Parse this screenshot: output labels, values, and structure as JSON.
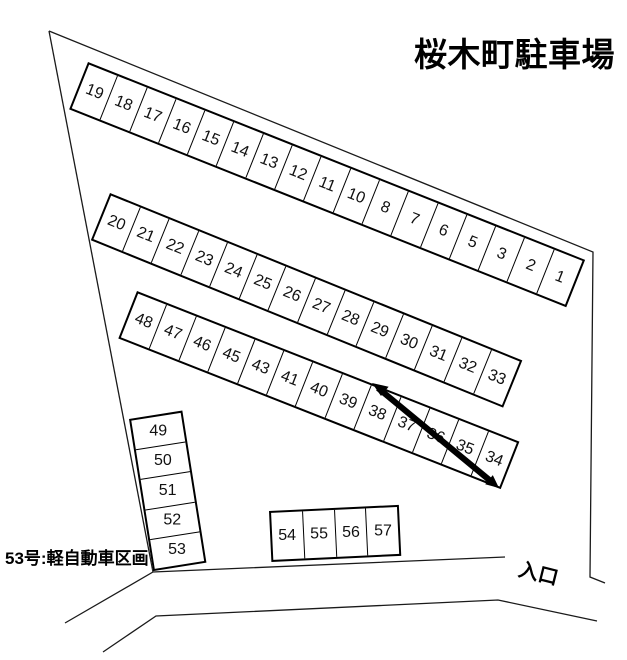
{
  "title": "桜木町駐車場",
  "notes": {
    "kei_section": "53号:軽自動車区画",
    "entrance": "入口"
  },
  "rows": [
    {
      "id": "row-upper",
      "stalls": [
        "19",
        "18",
        "17",
        "16",
        "15",
        "14",
        "13",
        "12",
        "11",
        "10",
        "8",
        "7",
        "6",
        "5",
        "3",
        "2",
        "1"
      ]
    },
    {
      "id": "row-middle",
      "stalls": [
        "20",
        "21",
        "22",
        "23",
        "24",
        "25",
        "26",
        "27",
        "28",
        "29",
        "30",
        "31",
        "32",
        "33"
      ]
    },
    {
      "id": "row-lower",
      "stalls": [
        "48",
        "47",
        "46",
        "45",
        "43",
        "41",
        "40",
        "39",
        "38",
        "37",
        "36",
        "35",
        "34"
      ]
    },
    {
      "id": "col-left",
      "stalls": [
        "49",
        "50",
        "51",
        "52",
        "53"
      ]
    },
    {
      "id": "row-bottom",
      "stalls": [
        "54",
        "55",
        "56",
        "57"
      ]
    }
  ],
  "annotations": {
    "barrier_line": "thick double-pointed diagonal line across stalls 38-34"
  },
  "colors": {
    "line": "#000000",
    "background": "#ffffff",
    "text": "#111111"
  }
}
